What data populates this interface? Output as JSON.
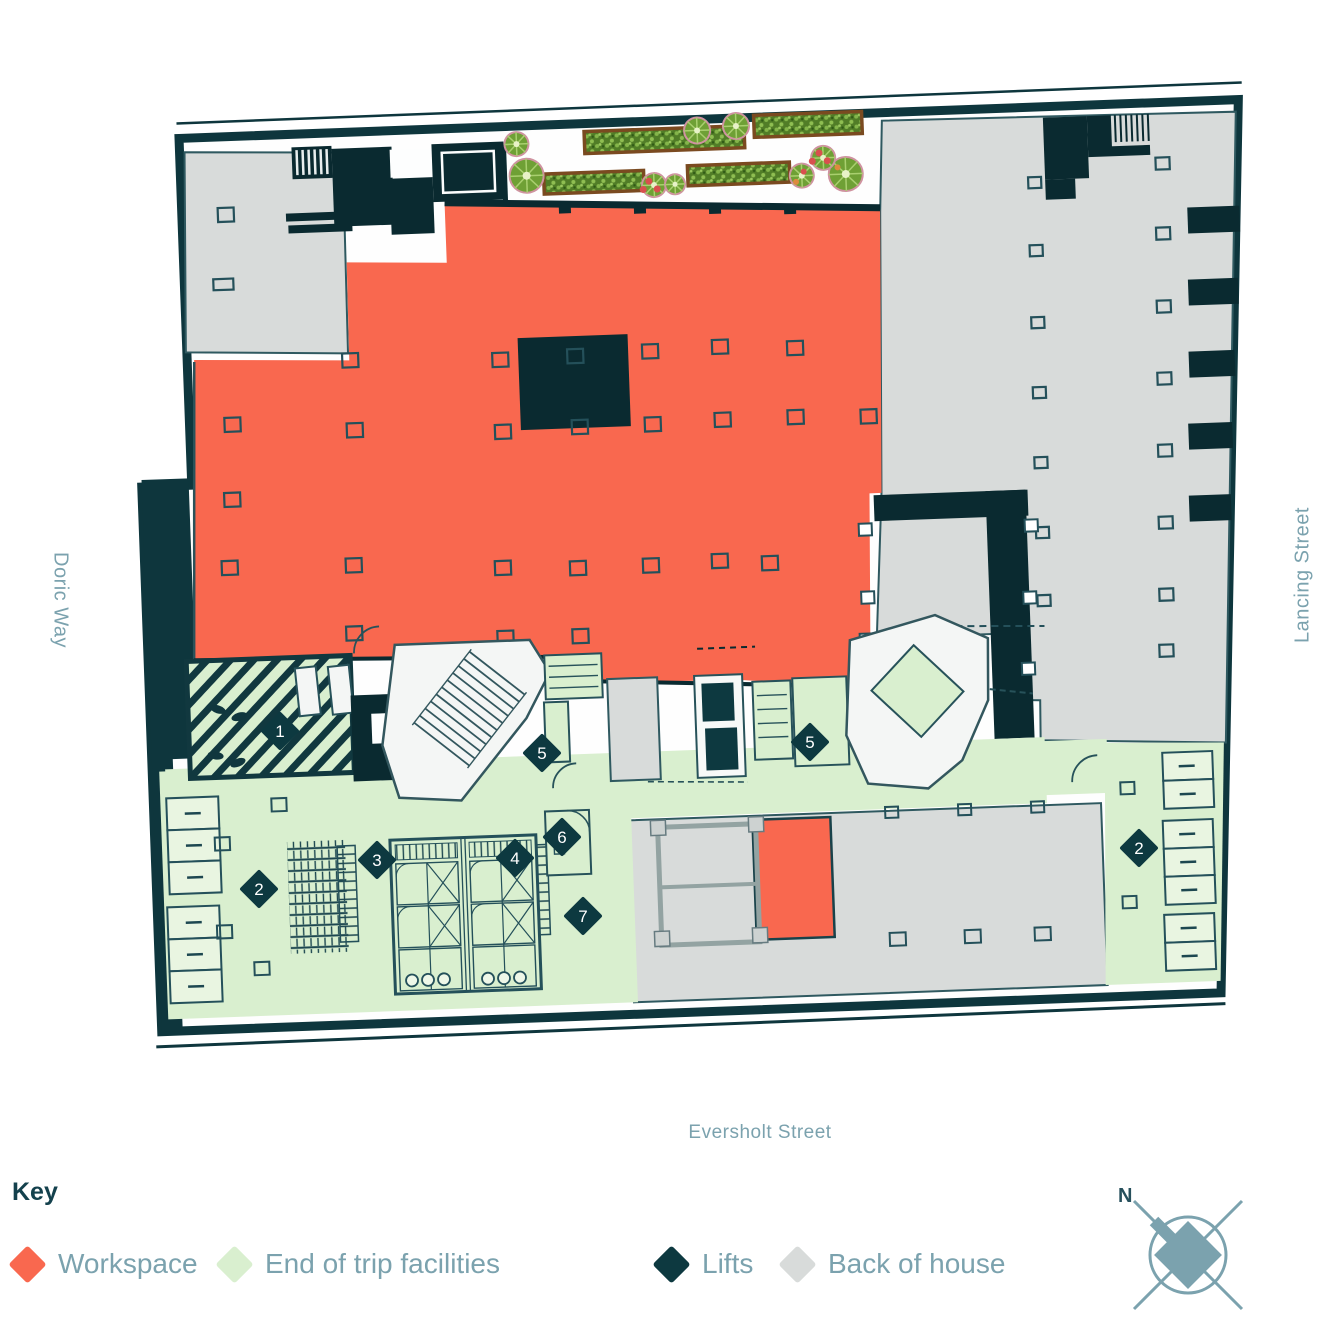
{
  "streets": {
    "left": "Doric Way",
    "right": "Lancing Street",
    "bottom": "Eversholt Street"
  },
  "key": {
    "title": "Key",
    "items": [
      {
        "label": "Workspace",
        "color": "#F9684F"
      },
      {
        "label": "End of trip facilities",
        "color": "#D9EFCF"
      },
      {
        "label": "Lifts",
        "color": "#0D3940"
      },
      {
        "label": "Back of house",
        "color": "#D8DBDA"
      }
    ]
  },
  "compass": {
    "label": "N"
  },
  "markers": [
    {
      "label": "1"
    },
    {
      "label": "2"
    },
    {
      "label": "3"
    },
    {
      "label": "4"
    },
    {
      "label": "5"
    },
    {
      "label": "5"
    },
    {
      "label": "6"
    },
    {
      "label": "7"
    },
    {
      "label": "2"
    }
  ],
  "colors": {
    "workspace": "#F9684F",
    "end_of_trip": "#D9EFCF",
    "lifts": "#0D3940",
    "back_of_house": "#D8DBDA",
    "walls": "#0E363D",
    "label_text": "#7BA2AE"
  }
}
